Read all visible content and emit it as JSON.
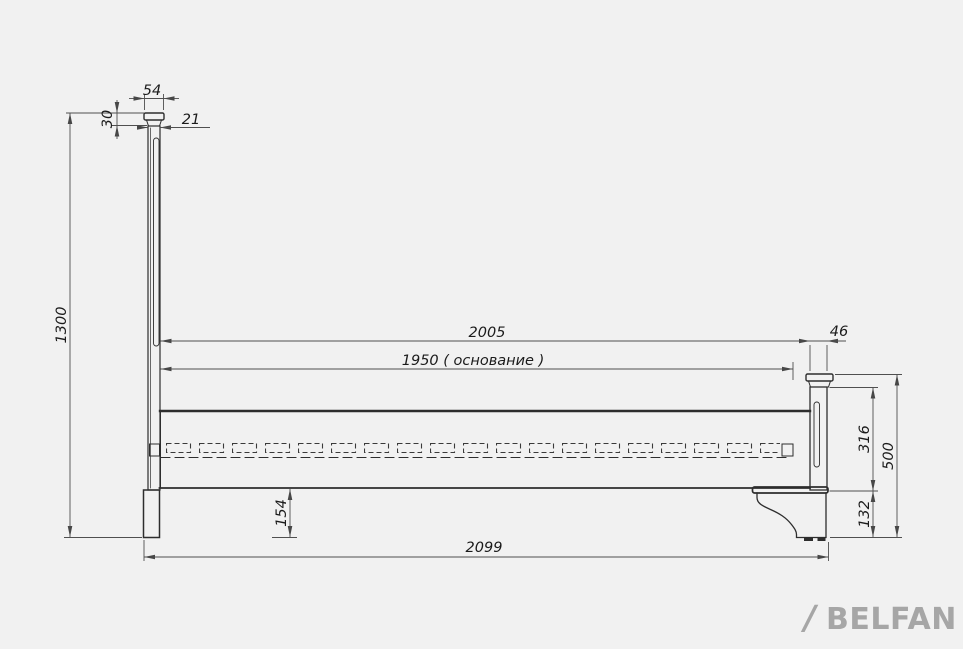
{
  "title": "Bed side view technical drawing",
  "canvas": {
    "background": "#f1f1f1",
    "outline_color": "#2d2d2d",
    "dimension_line_color": "#4f4f4f",
    "dimension_text_color": "#1b1b1b",
    "logo_color": "#a6a6a6"
  },
  "dimensions": {
    "cap_width": "54",
    "cap_height": "30",
    "post_thickness": "21",
    "overall_height": "1300",
    "frame_length": "2005",
    "base_length": "1950 ( основание )",
    "footboard_thickness": "46",
    "footboard_panel_height": "316",
    "footboard_height": "500",
    "under_rail_height": "154",
    "footboard_lower_height": "132",
    "overall_length": "2099"
  },
  "logo": {
    "slash": "/",
    "brand": "BELFAN"
  }
}
